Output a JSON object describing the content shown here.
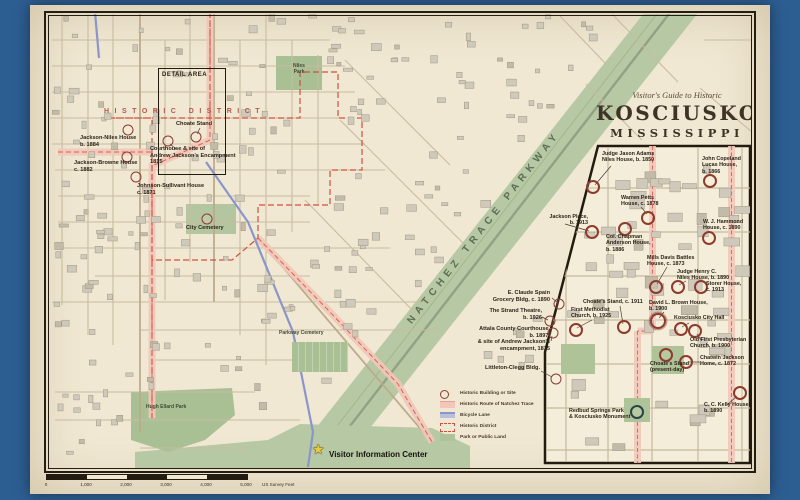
{
  "title": {
    "kicker": "Visitor's Guide to Historic",
    "city": "KOSCIUSKO",
    "state": "MISSISSIPPI"
  },
  "main_map": {
    "district_label": "HISTORIC DISTRICT",
    "detail_area_label": "DETAIL AREA",
    "parkway_label": "NATCHEZ TRACE PARKWAY",
    "niles_park_label": "Niles\nPark",
    "parkway_cemetery_label": "Parkway Cemetery",
    "hugh_ellard_park_label": "Hugh Ellard Park",
    "visitor_center_label": "Visitor Information Center",
    "sites": [
      {
        "label": "Jackson-Niles House\nb. 1884"
      },
      {
        "label": "Jackson-Browne House\nc. 1882"
      },
      {
        "label": "Johnson-Sullivant House\nc. 1871"
      },
      {
        "label": "Choate Stand"
      },
      {
        "label": "Courthouse & site of\nAndrew Jackson's Encampment\n1815"
      },
      {
        "label": "City Cemetery"
      },
      {
        "label": "E. Claude Spain\nGrocery Bldg, c. 1890"
      },
      {
        "label": "The Strand Theatre,\nb. 1926"
      },
      {
        "label": "Attala County Courthouse,\nb. 1897,\n& site of Andrew Jackson's\nencampment, 1815"
      },
      {
        "label": "Littleton-Clegg Bldg."
      }
    ]
  },
  "inset": {
    "sites": [
      {
        "label": "Judge Jason Adams\nNiles House, b. 1850"
      },
      {
        "label": "John Copeland\nLucas House,\nb. 1866"
      },
      {
        "label": "Warren Petts\nHouse, c. 1878"
      },
      {
        "label": "W. J. Hammond\nHouse, c. 1890"
      },
      {
        "label": "Jackson Place,\nb. 1913"
      },
      {
        "label": "Col. Chapman\nAnderson House,\nb. 1886"
      },
      {
        "label": "Mills Davis Battles\nHouse, c. 1873"
      },
      {
        "label": "Judge Henry C.\nNiles House, b. 1890"
      },
      {
        "label": "Storer House,\nc. 1913"
      },
      {
        "label": "Choate's Stand, c. 1911"
      },
      {
        "label": "First Methodist\nChurch, b. 1925"
      },
      {
        "label": "David L. Brown House,\nb. 1900"
      },
      {
        "label": "Kosciusko City Hall"
      },
      {
        "label": "Old First Presbyterian\nChurch, b. 1900"
      },
      {
        "label": "Chatwin Jackson\nHome, c. 1872"
      },
      {
        "label": "Choate's Stand\n(present-day)"
      },
      {
        "label": "C. C. Kelly House\nb. 1890"
      },
      {
        "label": "Redbud Springs Park\n& Kosciusko Monument"
      }
    ]
  },
  "legend": {
    "items": [
      {
        "swatch": "circle",
        "label": "Historic Building or Site"
      },
      {
        "swatch": "pink",
        "label": "Historic Route of Natchez Trace"
      },
      {
        "swatch": "blue",
        "label": "Bicycle Lane"
      },
      {
        "swatch": "dashed",
        "label": "Historic District"
      },
      {
        "swatch": "green",
        "label": "Park or Public Land"
      }
    ]
  },
  "scalebar": {
    "ticks": [
      "0",
      "1,000",
      "2,000",
      "3,000",
      "4,000",
      "5,000"
    ],
    "unit": "US Survey Feet"
  },
  "colors": {
    "accent_red": "#8e3b2c",
    "route_pink": "#f2c6b9",
    "bike_blue": "#8b95c9",
    "district_red": "#cf5140",
    "park_green": "#aec397",
    "border_blue": "#2d5e92"
  }
}
